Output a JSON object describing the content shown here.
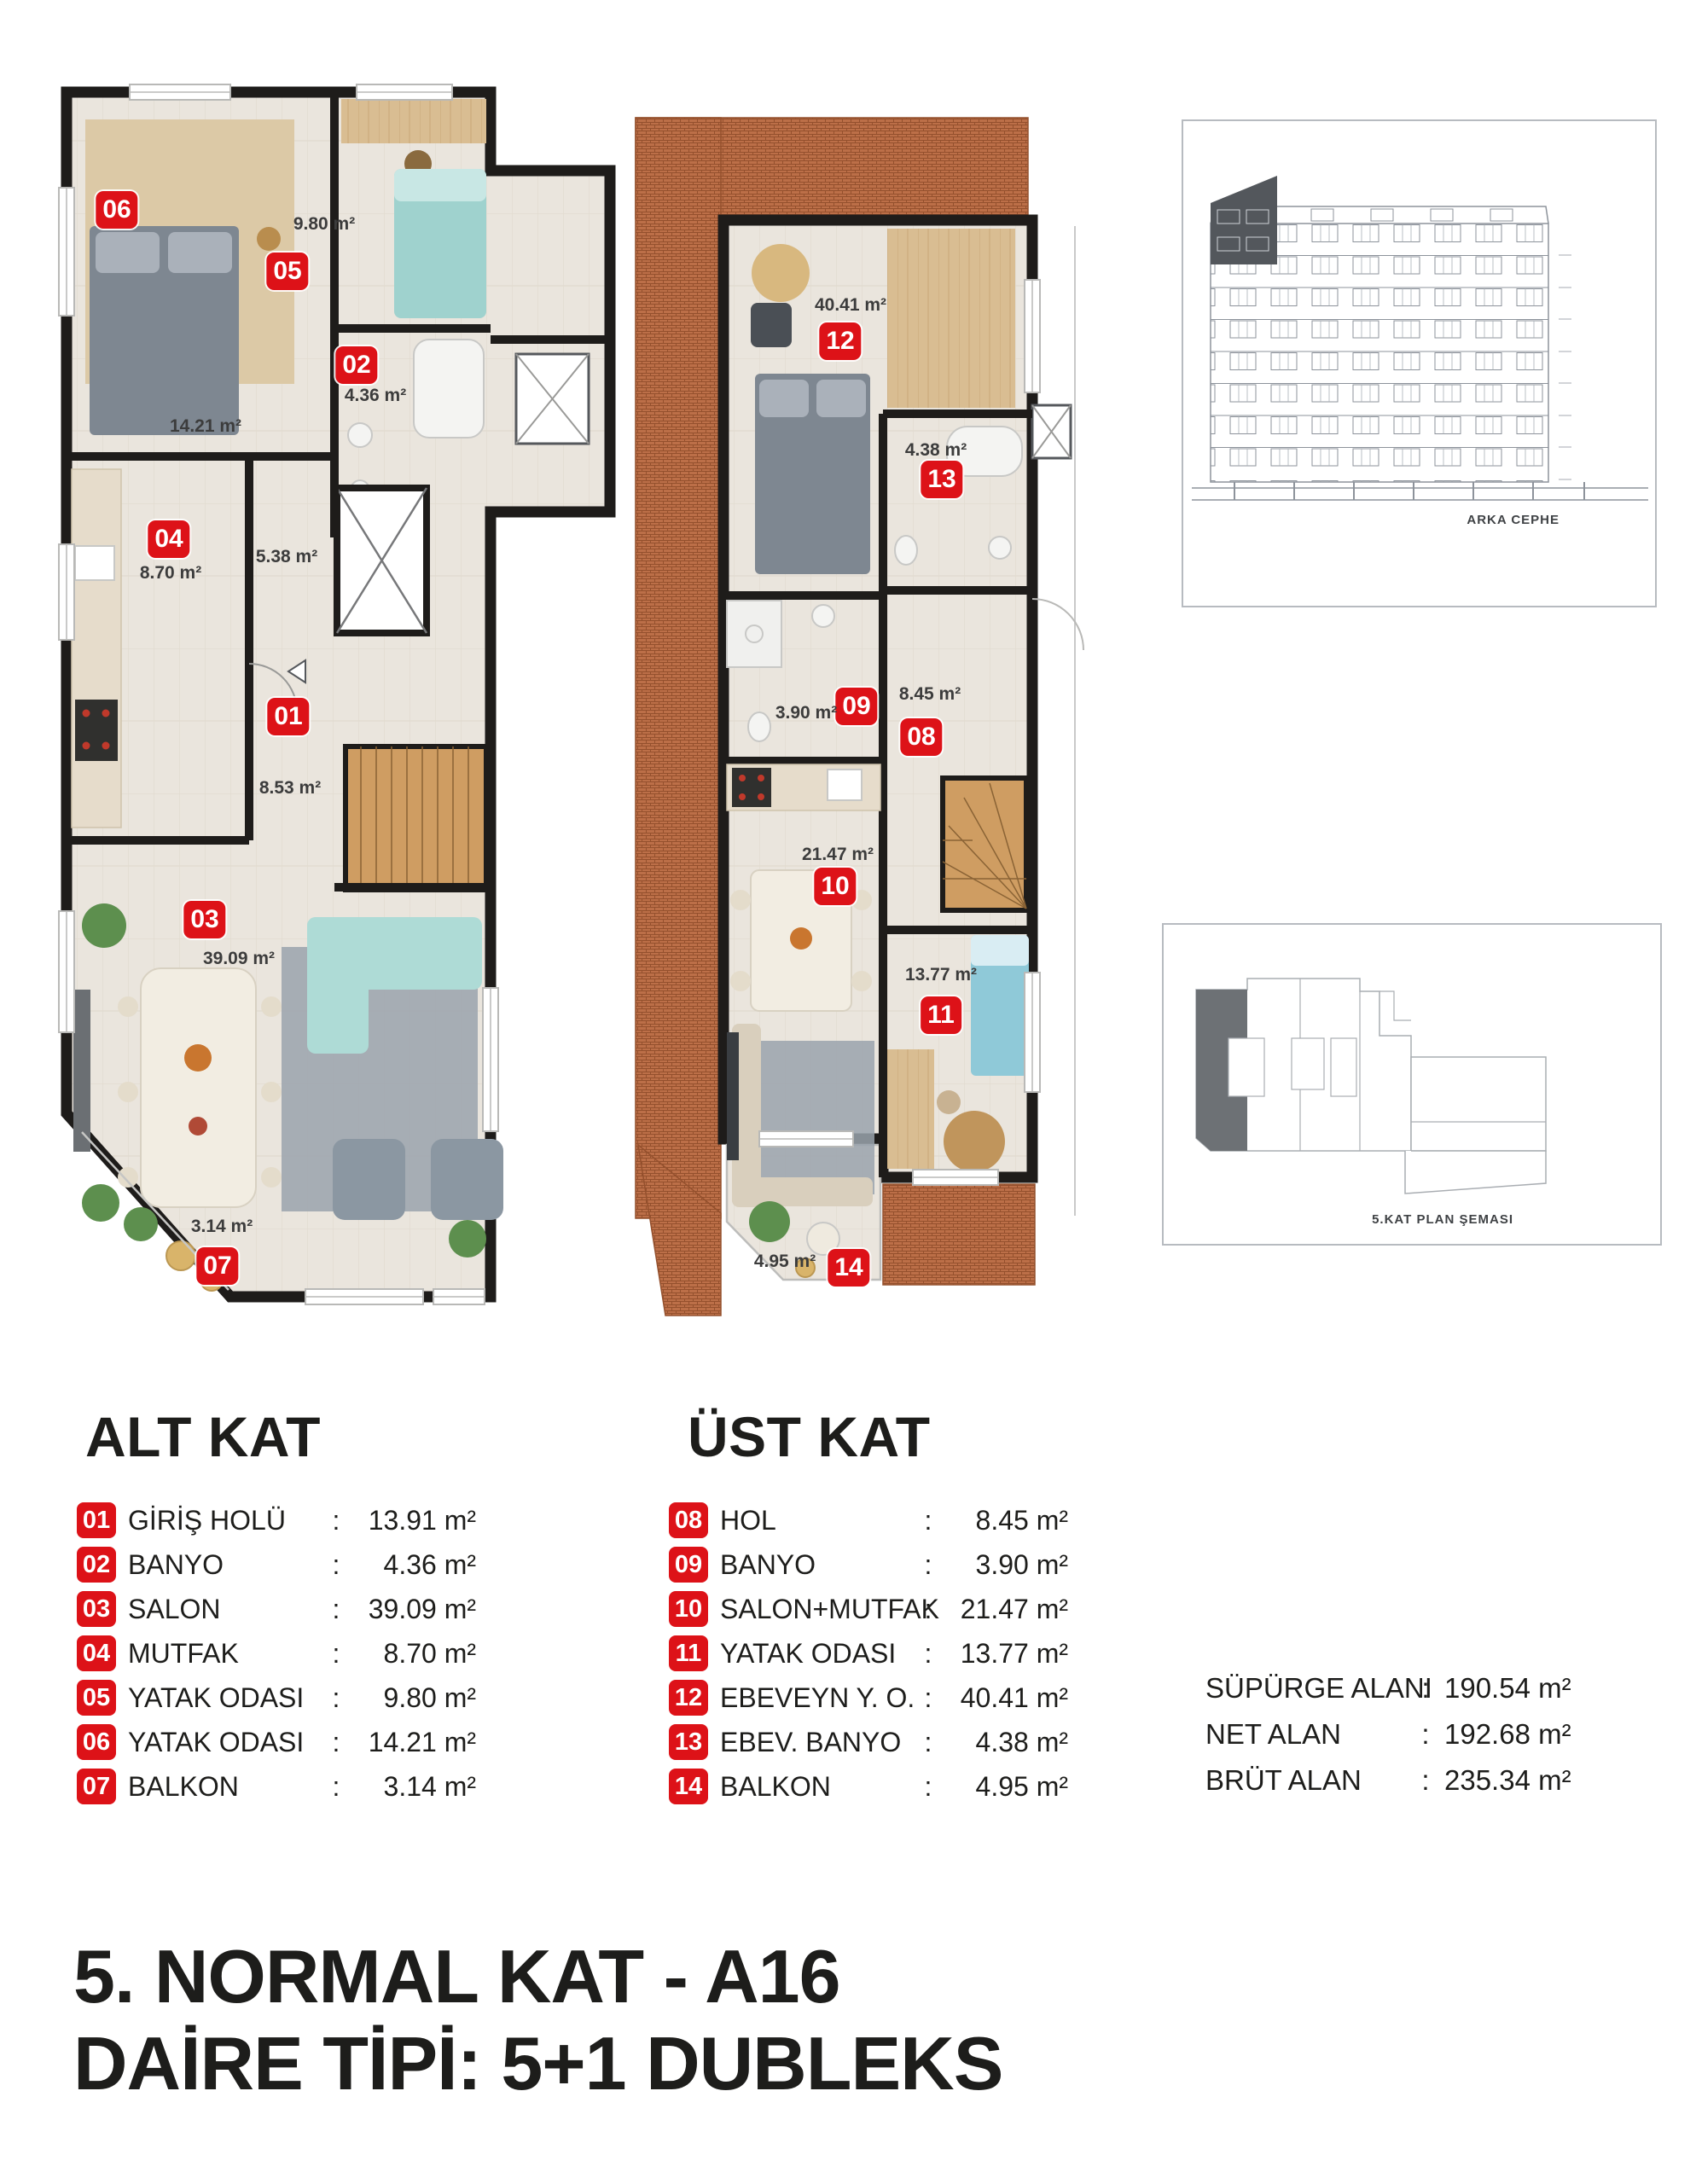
{
  "ui": {
    "colon": ":"
  },
  "colors": {
    "badge_red": "#dd1218",
    "wall_black": "#1e1c1a",
    "brick_terrace": "#bc6f48",
    "wood_floor": "#d9bd92",
    "light_floor": "#eae5dd"
  },
  "sections": {
    "lower_heading": "ALT KAT",
    "upper_heading": "ÜST KAT"
  },
  "plan_lower": {
    "badges": [
      "06",
      "05",
      "02",
      "04",
      "01",
      "03",
      "07"
    ],
    "areas": [
      "9.80 m²",
      "4.36 m²",
      "14.21 m²",
      "8.70 m²",
      "5.38 m²",
      "8.53 m²",
      "39.09 m²",
      "3.14 m²"
    ]
  },
  "plan_upper": {
    "badges": [
      "12",
      "13",
      "09",
      "08",
      "10",
      "11",
      "14"
    ],
    "areas": [
      "40.41 m²",
      "4.38 m²",
      "3.90 m²",
      "8.45 m²",
      "21.47 m²",
      "13.77 m²",
      "4.95 m²"
    ]
  },
  "legend_lower": {
    "items": [
      {
        "no": "01",
        "label": "GİRİŞ HOLÜ",
        "value": "13.91 m²"
      },
      {
        "no": "02",
        "label": "BANYO",
        "value": "4.36 m²"
      },
      {
        "no": "03",
        "label": "SALON",
        "value": "39.09 m²"
      },
      {
        "no": "04",
        "label": "MUTFAK",
        "value": "8.70 m²"
      },
      {
        "no": "05",
        "label": "YATAK ODASI",
        "value": "9.80 m²"
      },
      {
        "no": "06",
        "label": "YATAK ODASI",
        "value": "14.21 m²"
      },
      {
        "no": "07",
        "label": "BALKON",
        "value": "3.14 m²"
      }
    ]
  },
  "legend_upper": {
    "items": [
      {
        "no": "08",
        "label": "HOL",
        "value": "8.45 m²"
      },
      {
        "no": "09",
        "label": "BANYO",
        "value": "3.90 m²"
      },
      {
        "no": "10",
        "label": "SALON+MUTFAK",
        "value": "21.47 m²"
      },
      {
        "no": "11",
        "label": "YATAK ODASI",
        "value": "13.77 m²"
      },
      {
        "no": "12",
        "label": "EBEVEYN Y. O.",
        "value": "40.41 m²"
      },
      {
        "no": "13",
        "label": "EBEV. BANYO",
        "value": "4.38 m²"
      },
      {
        "no": "14",
        "label": "BALKON",
        "value": "4.95 m²"
      }
    ]
  },
  "summary": {
    "rows": [
      {
        "label": "SÜPÜRGE ALANI",
        "value": "190.54 m²"
      },
      {
        "label": "NET ALAN",
        "value": "192.68 m²"
      },
      {
        "label": "BRÜT ALAN",
        "value": "235.34 m²"
      }
    ]
  },
  "elevation": {
    "caption": "ARKA CEPHE"
  },
  "keyplan": {
    "caption": "5.KAT PLAN ŞEMASI"
  },
  "title": {
    "line1": "5. NORMAL KAT - A16",
    "line2": "DAİRE TİPİ: 5+1 DUBLEKS"
  }
}
